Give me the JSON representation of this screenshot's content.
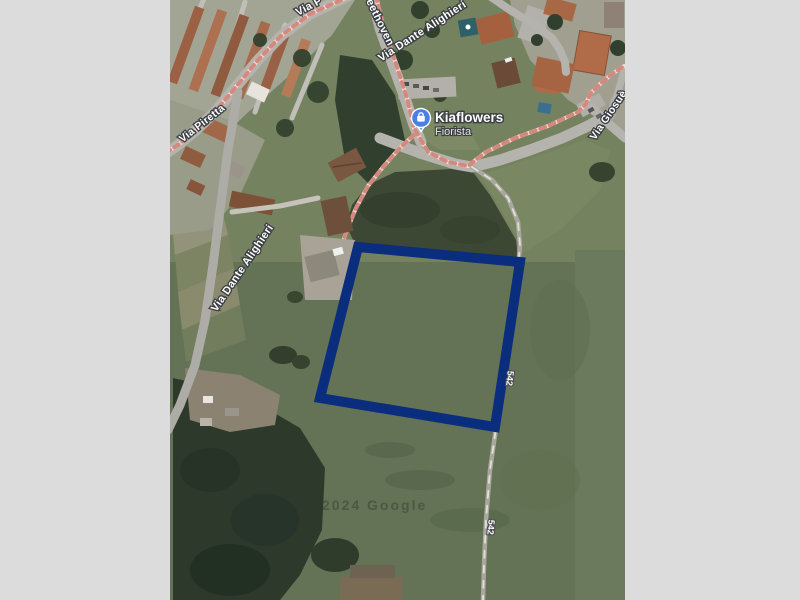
{
  "canvas": {
    "background": "#dcdcdc"
  },
  "map": {
    "type": "satellite-imagery",
    "labels": {
      "street_top_partial": "Via P",
      "street_beethoven_partial": "eethoven",
      "street_dante": "Via Dante Alighieri",
      "street_piretta": "Via Piretta",
      "street_giosue": "Via Giosuè",
      "route_number": "542",
      "watermark": "2024 Google"
    },
    "poi": {
      "name": "Kiaflowers",
      "category": "Fiorista",
      "icon": "shopping-bag-pin-icon",
      "pin_color": "#4a80e6"
    },
    "parcel": {
      "color": "#0b2d7d",
      "points": "188,247 350,262 325,427 150,398",
      "stroke_width": "10"
    },
    "colors": {
      "field_green": "#647355",
      "dark_field": "#3c4834",
      "trees": "#2d3a2b",
      "road_gray": "#b5b3ae",
      "path_pink": "#d4887e",
      "roof_terracotta": "#a86a4c"
    }
  }
}
